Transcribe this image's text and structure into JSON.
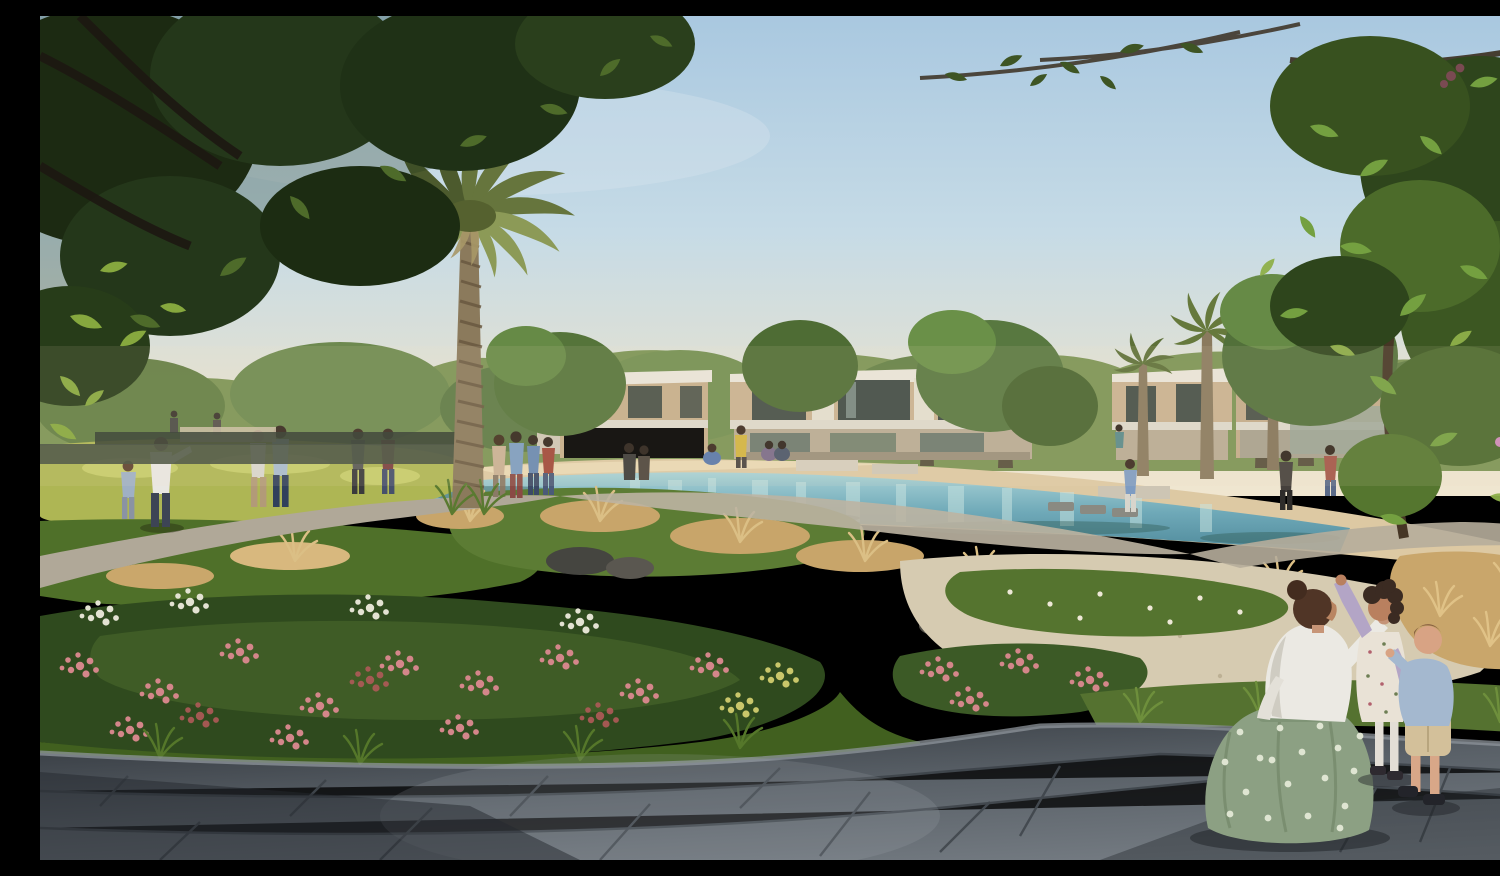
{
  "scene": {
    "title": "Residential community park — architectural rendering",
    "alt": "Photorealistic rendering of a landscaped community park at golden hour with a stream, palm trees, townhouses and people",
    "description": "Photorealistic rendering of a landscaped community park at golden hour. A turquoise stream winds between sandy banks and planted garden mounds in front of modern two-storey beige townhouses. A tall date palm rises left of centre, dark overhanging tree canopies frame the top corners, and small groups of people stroll on winding gravel paths. In the right foreground a woman in a white blouse and sage polka-dot skirt kneels on a grey stone plaza beside a girl in a white floral dress with a lavender cardigan who points upward, and a toddler in a chambray shirt and khaki shorts.",
    "time_of_day": "late afternoon golden hour",
    "weather": "clear pale-blue sky",
    "people_count_approx": 24,
    "foreground_group": {
      "woman": "kneeling, white blouse, sage green polka-dot skirt, dark hair in a bun, raising one hand",
      "girl": "white floral dress, lavender cardigan, curly dark hair, pointing upward",
      "toddler": "light blue chambray shirt, khaki shorts, dark shoes, arm raised"
    },
    "landscape_elements": [
      "date palm with textured trunk",
      "dark shade-tree canopy top left",
      "sunlit shade-tree canopy top right with pink blossoms",
      "turquoise stream with reflections",
      "sandy beach banks",
      "yellow-green groundcover",
      "tan ornamental grasses",
      "pink oleander flower beds",
      "white gravel beds",
      "winding gravel footpaths",
      "diagonal grey stone plaza paving",
      "modern beige and white townhouses with dark glazing",
      "row of background palm trees",
      "stepping stones across stream",
      "timber deck at stream edge"
    ],
    "palette": {
      "sky_top": "#a9c8e0",
      "sky_horizon": "#f0e6d0",
      "water": "#6fa9b8",
      "water_light": "#bcdcdc",
      "sand": "#ddc9a3",
      "gravel_white": "#d6cbb1",
      "foliage_dark": "#22330f",
      "foliage_sunlit": "#86ad4a",
      "groundcover_yellow": "#aeb654",
      "dry_grass": "#c9a66b",
      "flowers_pink": "#d4868a",
      "blossom_pink": "#cd8ab8",
      "building_beige": "#c9b290",
      "building_trim": "#e9e5da",
      "window_glass": "#454f47",
      "plaza_light": "#7b8289",
      "plaza_shadow": "#2c3137",
      "skirt_green": "#8ca083",
      "cardigan_lavender": "#b3a5c6",
      "toddler_shirt": "#a4b8cf"
    }
  }
}
